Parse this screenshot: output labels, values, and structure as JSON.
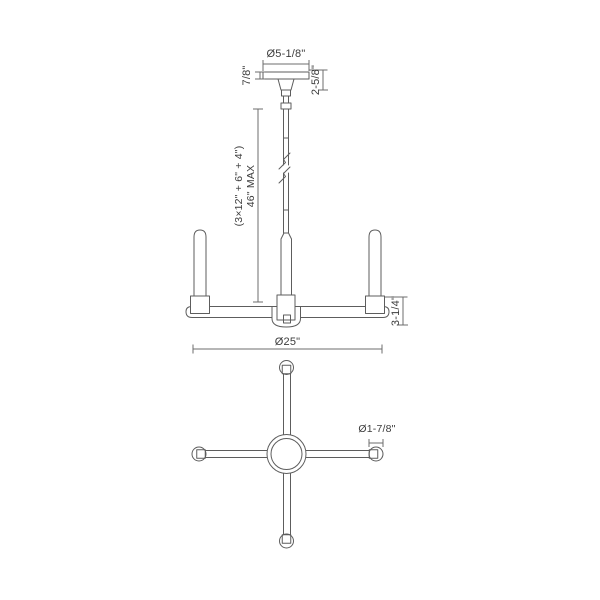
{
  "palette": {
    "background": "#ffffff",
    "fixture_line": "#5d5d5d",
    "dimension_line": "#6c6c6c",
    "text": "#3c3c3c"
  },
  "views": {
    "elevation": {
      "canopy_diameter": "Ø5-1/8\"",
      "canopy_thickness": "7/8\"",
      "canopy_drop": "2-5/8\"",
      "rod_max_line1": "46\" MAX",
      "rod_max_line2": "(3×12\" + 6\" + 4\")",
      "body_height": "3-1/4\"",
      "fixture_diameter": "Ø25\""
    },
    "plan": {
      "arm_end_diameter": "Ø1-7/8\""
    }
  }
}
